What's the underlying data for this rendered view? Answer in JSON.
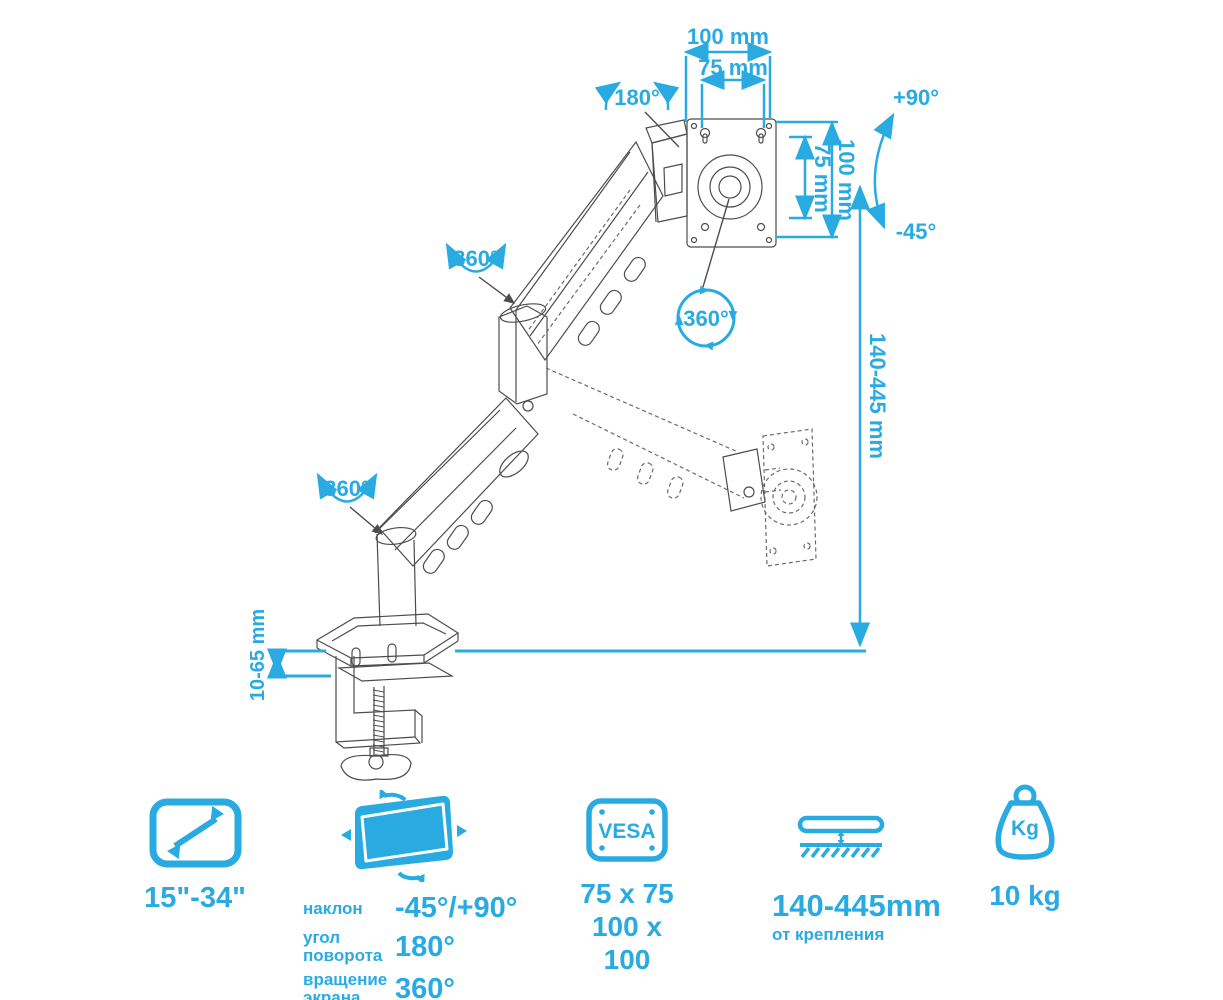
{
  "colors": {
    "accent": "#29abe2",
    "line_art": "#4d4d4d"
  },
  "annotations": {
    "vesa_width_outer": "100 mm",
    "vesa_width_inner": "75 mm",
    "vesa_height_inner": "75 mm",
    "vesa_height_outer": "100 mm",
    "head_rotation": "180°",
    "tilt_up": "+90°",
    "tilt_down": "-45°",
    "plate_rotation": "360°",
    "elbow_rotation": "360°",
    "base_rotation": "360°",
    "height_range": "140-445 mm",
    "clamp_thickness": "10-65 mm"
  },
  "specs": {
    "screen_size": {
      "icon": "diagonal-screen-size-icon",
      "value": "15\"-34\""
    },
    "angles": {
      "icon": "screen-tilt-icon",
      "rows": [
        {
          "label": "наклон",
          "value": "-45°/+90°"
        },
        {
          "label": "угол поворота",
          "value": "180°"
        },
        {
          "label": "вращение экрана",
          "value": "360°"
        }
      ]
    },
    "vesa": {
      "icon": "vesa-plate-icon",
      "icon_text": "VESA",
      "line1": "75 x 75",
      "line2": "100 x 100"
    },
    "height": {
      "icon": "desk-height-icon",
      "value": "140-445mm",
      "sub": "от крепления"
    },
    "weight": {
      "icon": "kg-weight-icon",
      "icon_text": "Kg",
      "value": "10 kg"
    }
  }
}
